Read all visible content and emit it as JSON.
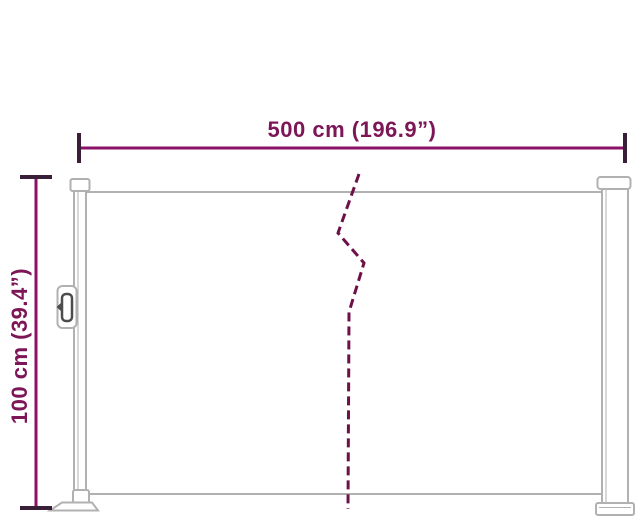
{
  "figure": {
    "kind": "product-dimension-diagram",
    "width_label": "500 cm (196.9”)",
    "height_label": "100 cm (39.4”)",
    "width_cm": 500,
    "width_in": 196.9,
    "height_cm": 100,
    "height_in": 39.4
  },
  "colors": {
    "dimension_text": "#7d1657",
    "dimension_line": "#8a1166",
    "dimension_cap": "#3a1f38",
    "break_line": "#6d1048",
    "outline_gray": "#b1b1b1",
    "handle_dark": "#4d4d4d",
    "background": "#ffffff"
  }
}
